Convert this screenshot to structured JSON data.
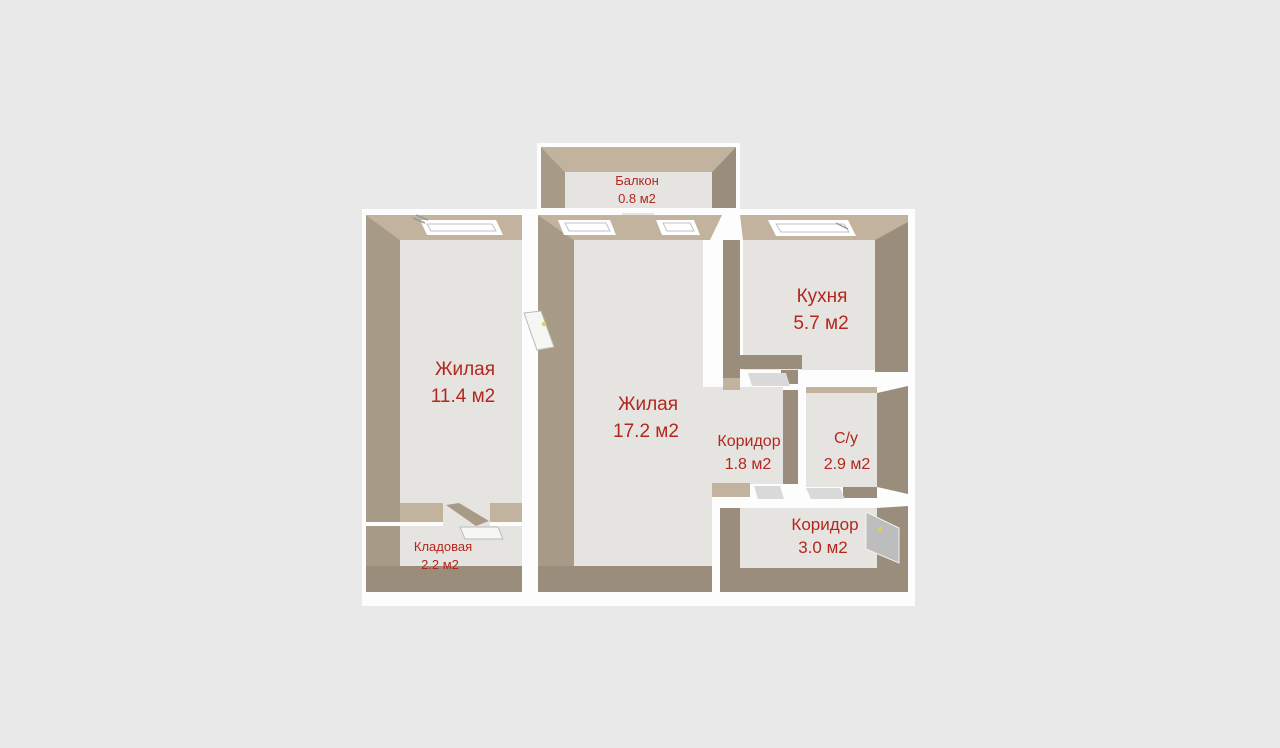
{
  "page": {
    "background": "#e9e9e9"
  },
  "colors": {
    "slab_white": "#fdfdfd",
    "floor": "#e6e4e1",
    "wall_light": "#c1b39d",
    "wall_mid": "#a79a87",
    "wall_dark": "#9a8d7c",
    "label_red": "#b3271e",
    "window_white": "#ffffff",
    "door_gray": "#bdbdbd",
    "door_light": "#d9d9d9",
    "door_white": "#f6f6f4",
    "handle_yellow": "#e3cf52"
  },
  "plan": {
    "title": "2-room apartment floor plan",
    "area_unit": "м2"
  },
  "rooms": [
    {
      "id": "balcony",
      "label": "Балкон",
      "area": "0.8 м2"
    },
    {
      "id": "living-1",
      "label": "Жилая",
      "area": "11.4 м2"
    },
    {
      "id": "living-2",
      "label": "Жилая",
      "area": "17.2 м2"
    },
    {
      "id": "kitchen",
      "label": "Кухня",
      "area": "5.7 м2"
    },
    {
      "id": "corridor-1",
      "label": "Коридор",
      "area": "1.8 м2"
    },
    {
      "id": "bathroom",
      "label": "С/у",
      "area": "2.9 м2"
    },
    {
      "id": "corridor-2",
      "label": "Коридор",
      "area": "3.0 м2"
    },
    {
      "id": "storage",
      "label": "Кладовая",
      "area": "2.2 м2"
    }
  ]
}
